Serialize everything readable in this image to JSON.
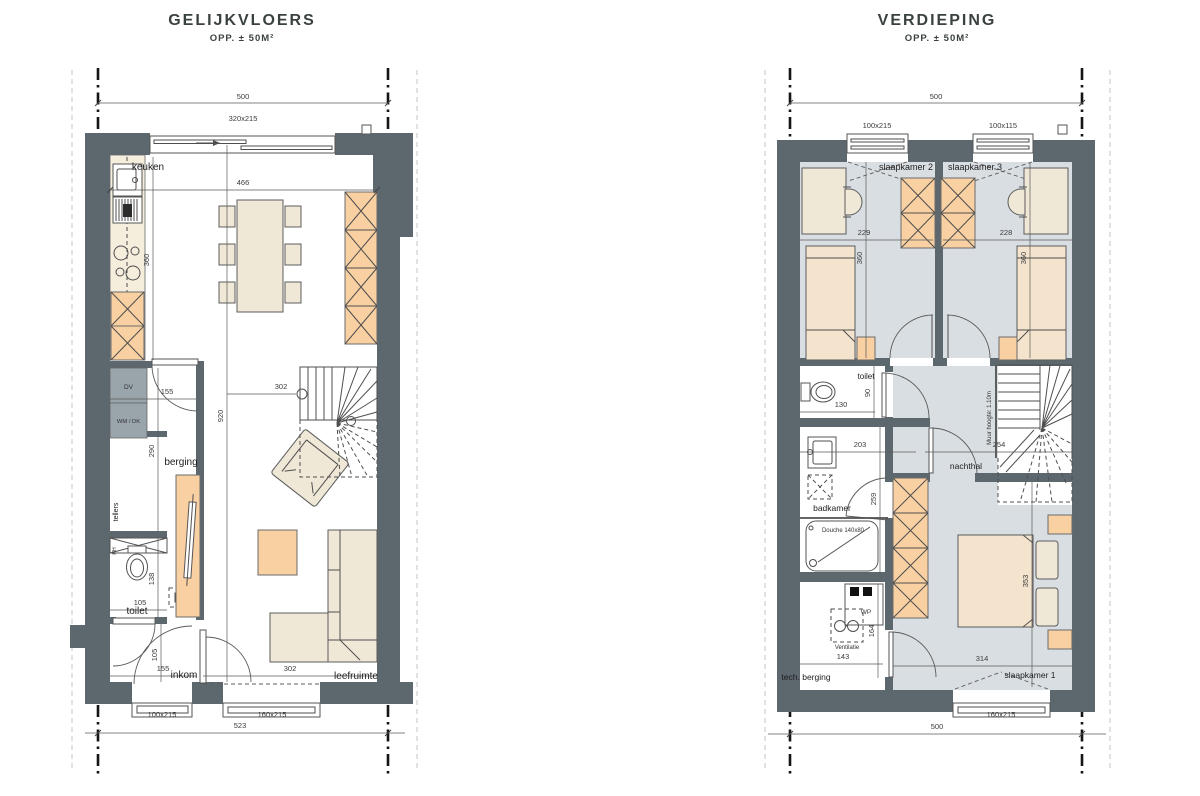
{
  "palette": {
    "wall": "#5d676e",
    "orange": "#f8d0a2",
    "beige": "#efe8d7",
    "bed": "#f4e4cd",
    "counter": "#f5eedd",
    "floor_blue": "#d9dee3",
    "gray_box": "#9aa4ab"
  },
  "left_plan": {
    "title": "GELIJKVLOERS",
    "subtitle": "OPP. ± 50M²",
    "rooms": {
      "keuken": "keuken",
      "berging": "berging",
      "toilet": "toilet",
      "inkom": "inkom",
      "leefruimte": "leefruimte",
      "tellers": "tellers"
    },
    "fixtures": {
      "dv": "DV",
      "wm_dk": "WM / DK",
      "hh": "HH"
    },
    "dims": {
      "total_top": "500",
      "window_top": "320x215",
      "interior_width": "466",
      "kitchen_depth": "360",
      "interior_depth": "920",
      "berging_width": "155",
      "berging_depth": "290",
      "stair_level": "302",
      "toilet_width": "105",
      "toilet_depth": "138",
      "inkom_height": "105",
      "inkom_width": "155",
      "living_width": "302",
      "door_front": "100x215",
      "window_living": "160x215",
      "total_bottom": "523"
    }
  },
  "right_plan": {
    "title": "VERDIEPING",
    "subtitle": "OPP. ± 50M²",
    "rooms": {
      "slaapkamer2": "slaapkamer 2",
      "slaapkamer3": "slaapkamer 3",
      "slaapkamer1": "slaapkamer 1",
      "toilet": "toilet",
      "badkamer": "badkamer",
      "nachthal": "nachthal",
      "tech_berging": "tech. berging"
    },
    "fixtures": {
      "wp": "WP",
      "ventilatie": "Ventilatie",
      "douche": "Douche 140x80",
      "muur_hoogte": "Muur hoogte: 1.10m"
    },
    "dims": {
      "total_top": "500",
      "window_sk2": "100x215",
      "window_sk3": "100x115",
      "sk2_width": "229",
      "sk3_width": "228",
      "sk2_depth": "360",
      "sk3_depth": "360",
      "toilet_width": "130",
      "toilet_depth": "90",
      "badkamer_width": "203",
      "nachthal_width": "254",
      "badkamer_depth": "259",
      "tech_width": "143",
      "tech_depth": "164",
      "sk1_width": "314",
      "sk1_depth": "353",
      "window_sk1": "160x215",
      "total_bottom": "500"
    }
  }
}
